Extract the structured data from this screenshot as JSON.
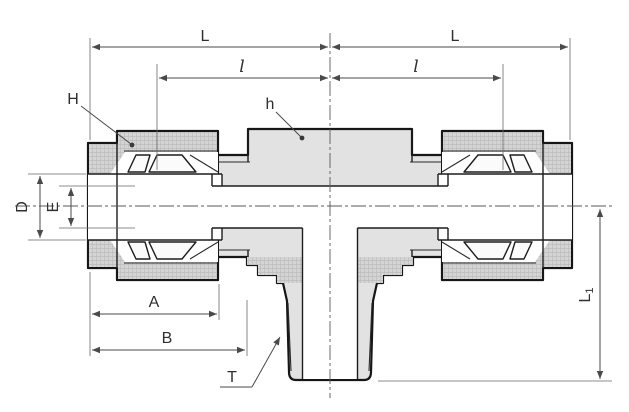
{
  "drawing": {
    "type": "technical-diagram",
    "subject": "tube-fitting-tee-cross-section",
    "labels": {
      "length_top_left": "L",
      "length_top_right": "L",
      "sub_length_left": "l",
      "sub_length_right": "l",
      "nut_callout": "H",
      "body_callout": "h",
      "tube_od": "D",
      "bore": "E",
      "nut_length": "A",
      "body_length": "B",
      "thread_callout": "T",
      "branch_length_main": "L",
      "branch_length_sub": "1"
    },
    "colors": {
      "background": "#ffffff",
      "outline": "#161616",
      "internal_line": "#1d1d1d",
      "dimension_line": "#4a4a4a",
      "label_text": "#2f2f2f",
      "body_fill": "#e2e2e2",
      "nut_fill": "#d4d4d4",
      "bore_fill": "#ffffff"
    }
  }
}
